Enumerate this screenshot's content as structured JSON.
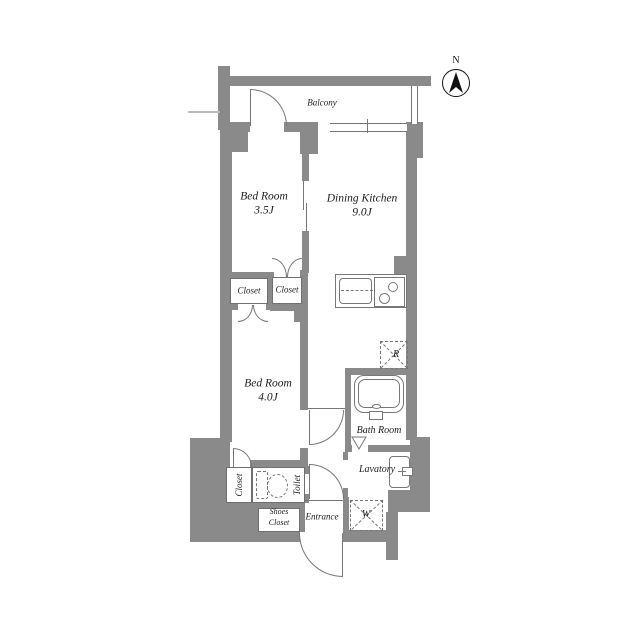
{
  "plan": {
    "title": "apartment-floor-plan",
    "compass": {
      "north_label": "N"
    },
    "labels": {
      "balcony": "Balcony",
      "bedroom1_name": "Bed Room",
      "bedroom1_size": "3.5J",
      "dk_name": "Dining Kitchen",
      "dk_size": "9.0J",
      "bedroom2_name": "Bed Room",
      "bedroom2_size": "4.0J",
      "closet_left": "Closet",
      "closet_right": "Closet",
      "closet_lower": "Closet",
      "toilet": "Toilet",
      "shoes_line1": "Shoes",
      "shoes_line2": "Closet",
      "entrance": "Entrance",
      "lavatory": "Lavatory",
      "bathroom": "Bath Room",
      "refrigerator": "R",
      "washer": "W"
    },
    "colors": {
      "wall": "#8a8a8a",
      "line": "#777777",
      "text": "#1c1c1c",
      "background": "#ffffff"
    }
  }
}
